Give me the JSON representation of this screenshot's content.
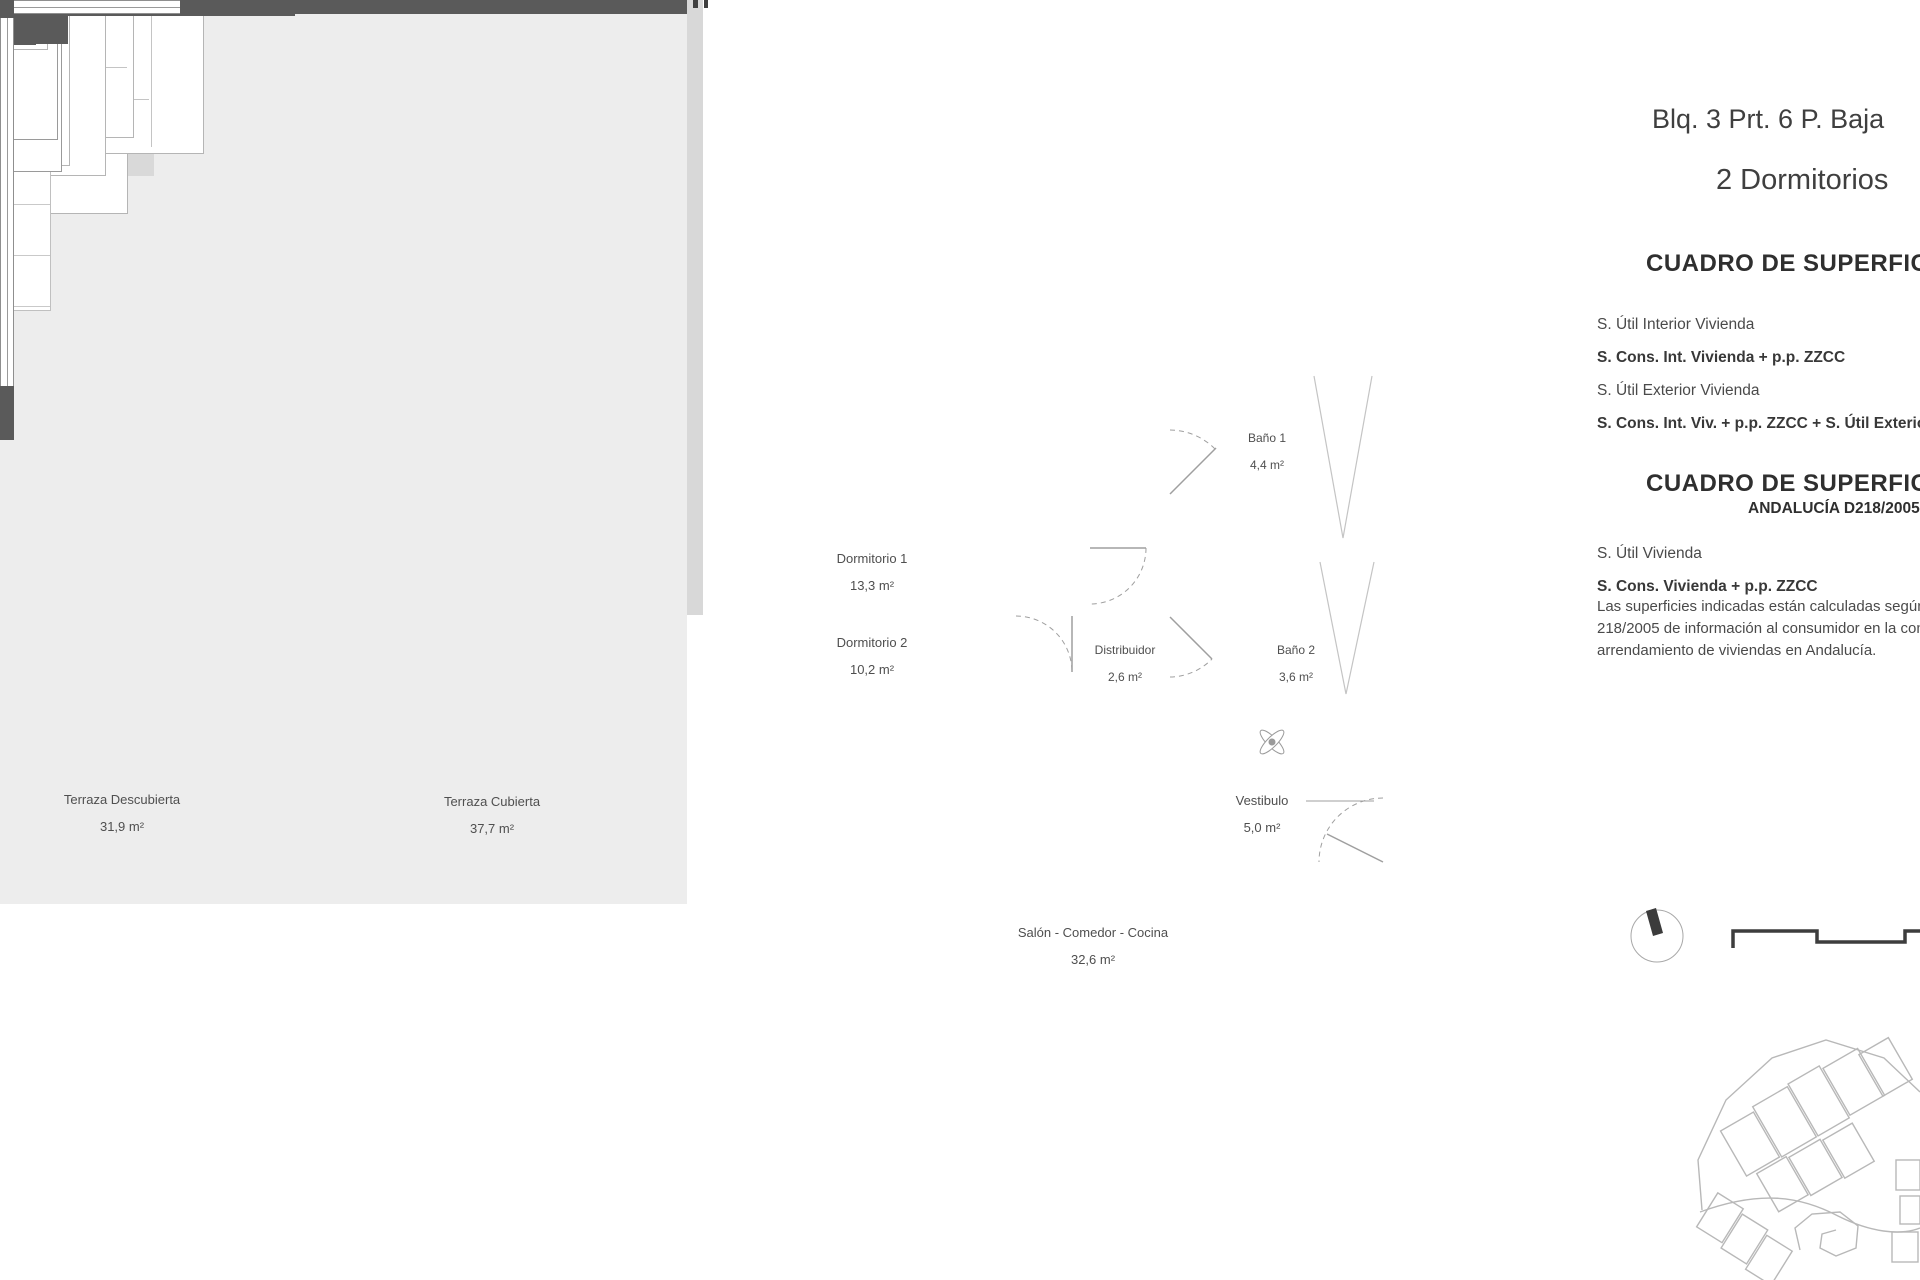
{
  "header": {
    "line1": "Blq. 3 Prt. 6 P. Baja",
    "line2": "2 Dormitorios"
  },
  "tables": {
    "t1": {
      "heading": "CUADRO DE SUPERFICIES",
      "rows": [
        {
          "label": "S. Útil Interior Vivienda"
        },
        {
          "label": "S. Cons. Int. Vivienda + p.p. ZZCC"
        },
        {
          "label": "S. Útil Exterior Vivienda"
        },
        {
          "label": "S. Cons. Int. Viv. + p.p. ZZCC + S. Útil Exterior"
        }
      ]
    },
    "t2": {
      "heading": "CUADRO DE SUPERFICIES",
      "subheading": "ANDALUCÍA D218/2005",
      "rows": [
        {
          "label": "S. Útil Vivienda"
        },
        {
          "label": "S. Cons. Vivienda + p.p. ZZCC"
        }
      ],
      "note1": "Las superficies indicadas están calculadas según el Decreto",
      "note2": "218/2005 de información al consumidor en la compraventa y",
      "note3": "arrendamiento de viviendas en Andalucía."
    }
  },
  "rooms": {
    "dormitorio1": {
      "name": "Dormitorio 1",
      "area": "13,3 m²"
    },
    "dormitorio2": {
      "name": "Dormitorio 2",
      "area": "10,2 m²"
    },
    "bano1": {
      "name": "Baño 1",
      "area": "4,4 m²"
    },
    "bano2": {
      "name": "Baño 2",
      "area": "3,6 m²"
    },
    "distribuidor": {
      "name": "Distribuidor",
      "area": "2,6 m²"
    },
    "vestibulo": {
      "name": "Vestibulo",
      "area": "5,0 m²"
    },
    "salon": {
      "name": "Salón - Comedor - Cocina",
      "area": "32,6 m²"
    },
    "terraza_descubierta": {
      "name": "Terraza Descubierta",
      "area": "31,9 m²"
    },
    "terraza_cubierta": {
      "name": "Terraza Cubierta",
      "area": "37,7 m²"
    }
  },
  "colors": {
    "wall": "#5a5a5a",
    "terrace_fill": "#d8d8d8",
    "floor_fill": "#ededed",
    "wet_room_fill": "#d9d9d9",
    "furniture_line": "#b5b5b5",
    "text": "#4f4f4f"
  }
}
